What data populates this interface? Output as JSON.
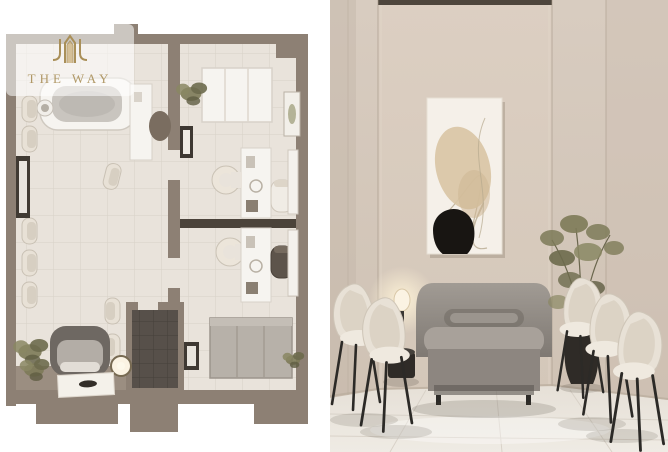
{
  "watermark": {
    "brand": "THE WAY",
    "logo_icon": "arch-building-logo",
    "color": "#a98f58"
  },
  "panels": {
    "left_label": "3D top-view floor plan of clinic office unit",
    "right_label": "Interior render of beige waiting room with sofa, guest chairs, wall art and plant"
  },
  "colors": {
    "background": "#ffffff",
    "watermark_gold": "#a98f58",
    "plan_wall": "#8d8074",
    "plan_wall_dark": "#6f6358",
    "plan_floor": "#e9e3db",
    "plan_tile_line": "#d8d1c7",
    "plan_platform": "#9b8e81",
    "bathroom_floor": "#57504a",
    "divider_dark": "#4b433a",
    "furniture_white": "#f6f4f0",
    "sofa_plan_dark": "#6e6862",
    "sofa_plan_seat": "#b3ada6",
    "chair_cream": "#e8e1d6",
    "chair_dark": "#5d544b",
    "plant_olive": "#7d7a58",
    "room_wall": "#d3c6b8",
    "room_wall_panel": "#d9cdc0",
    "ceiling_recess": "#4e463d",
    "art_canvas": "#f5f0e9",
    "art_beige": "#d9c5a5",
    "art_black": "#181512",
    "sofa_gray": "#948e87",
    "marble_floor": "#ece7e0",
    "lamp_glow": "#fbf3e3",
    "vase_black": "#2f2b27",
    "leg_black": "#2c2a27"
  }
}
